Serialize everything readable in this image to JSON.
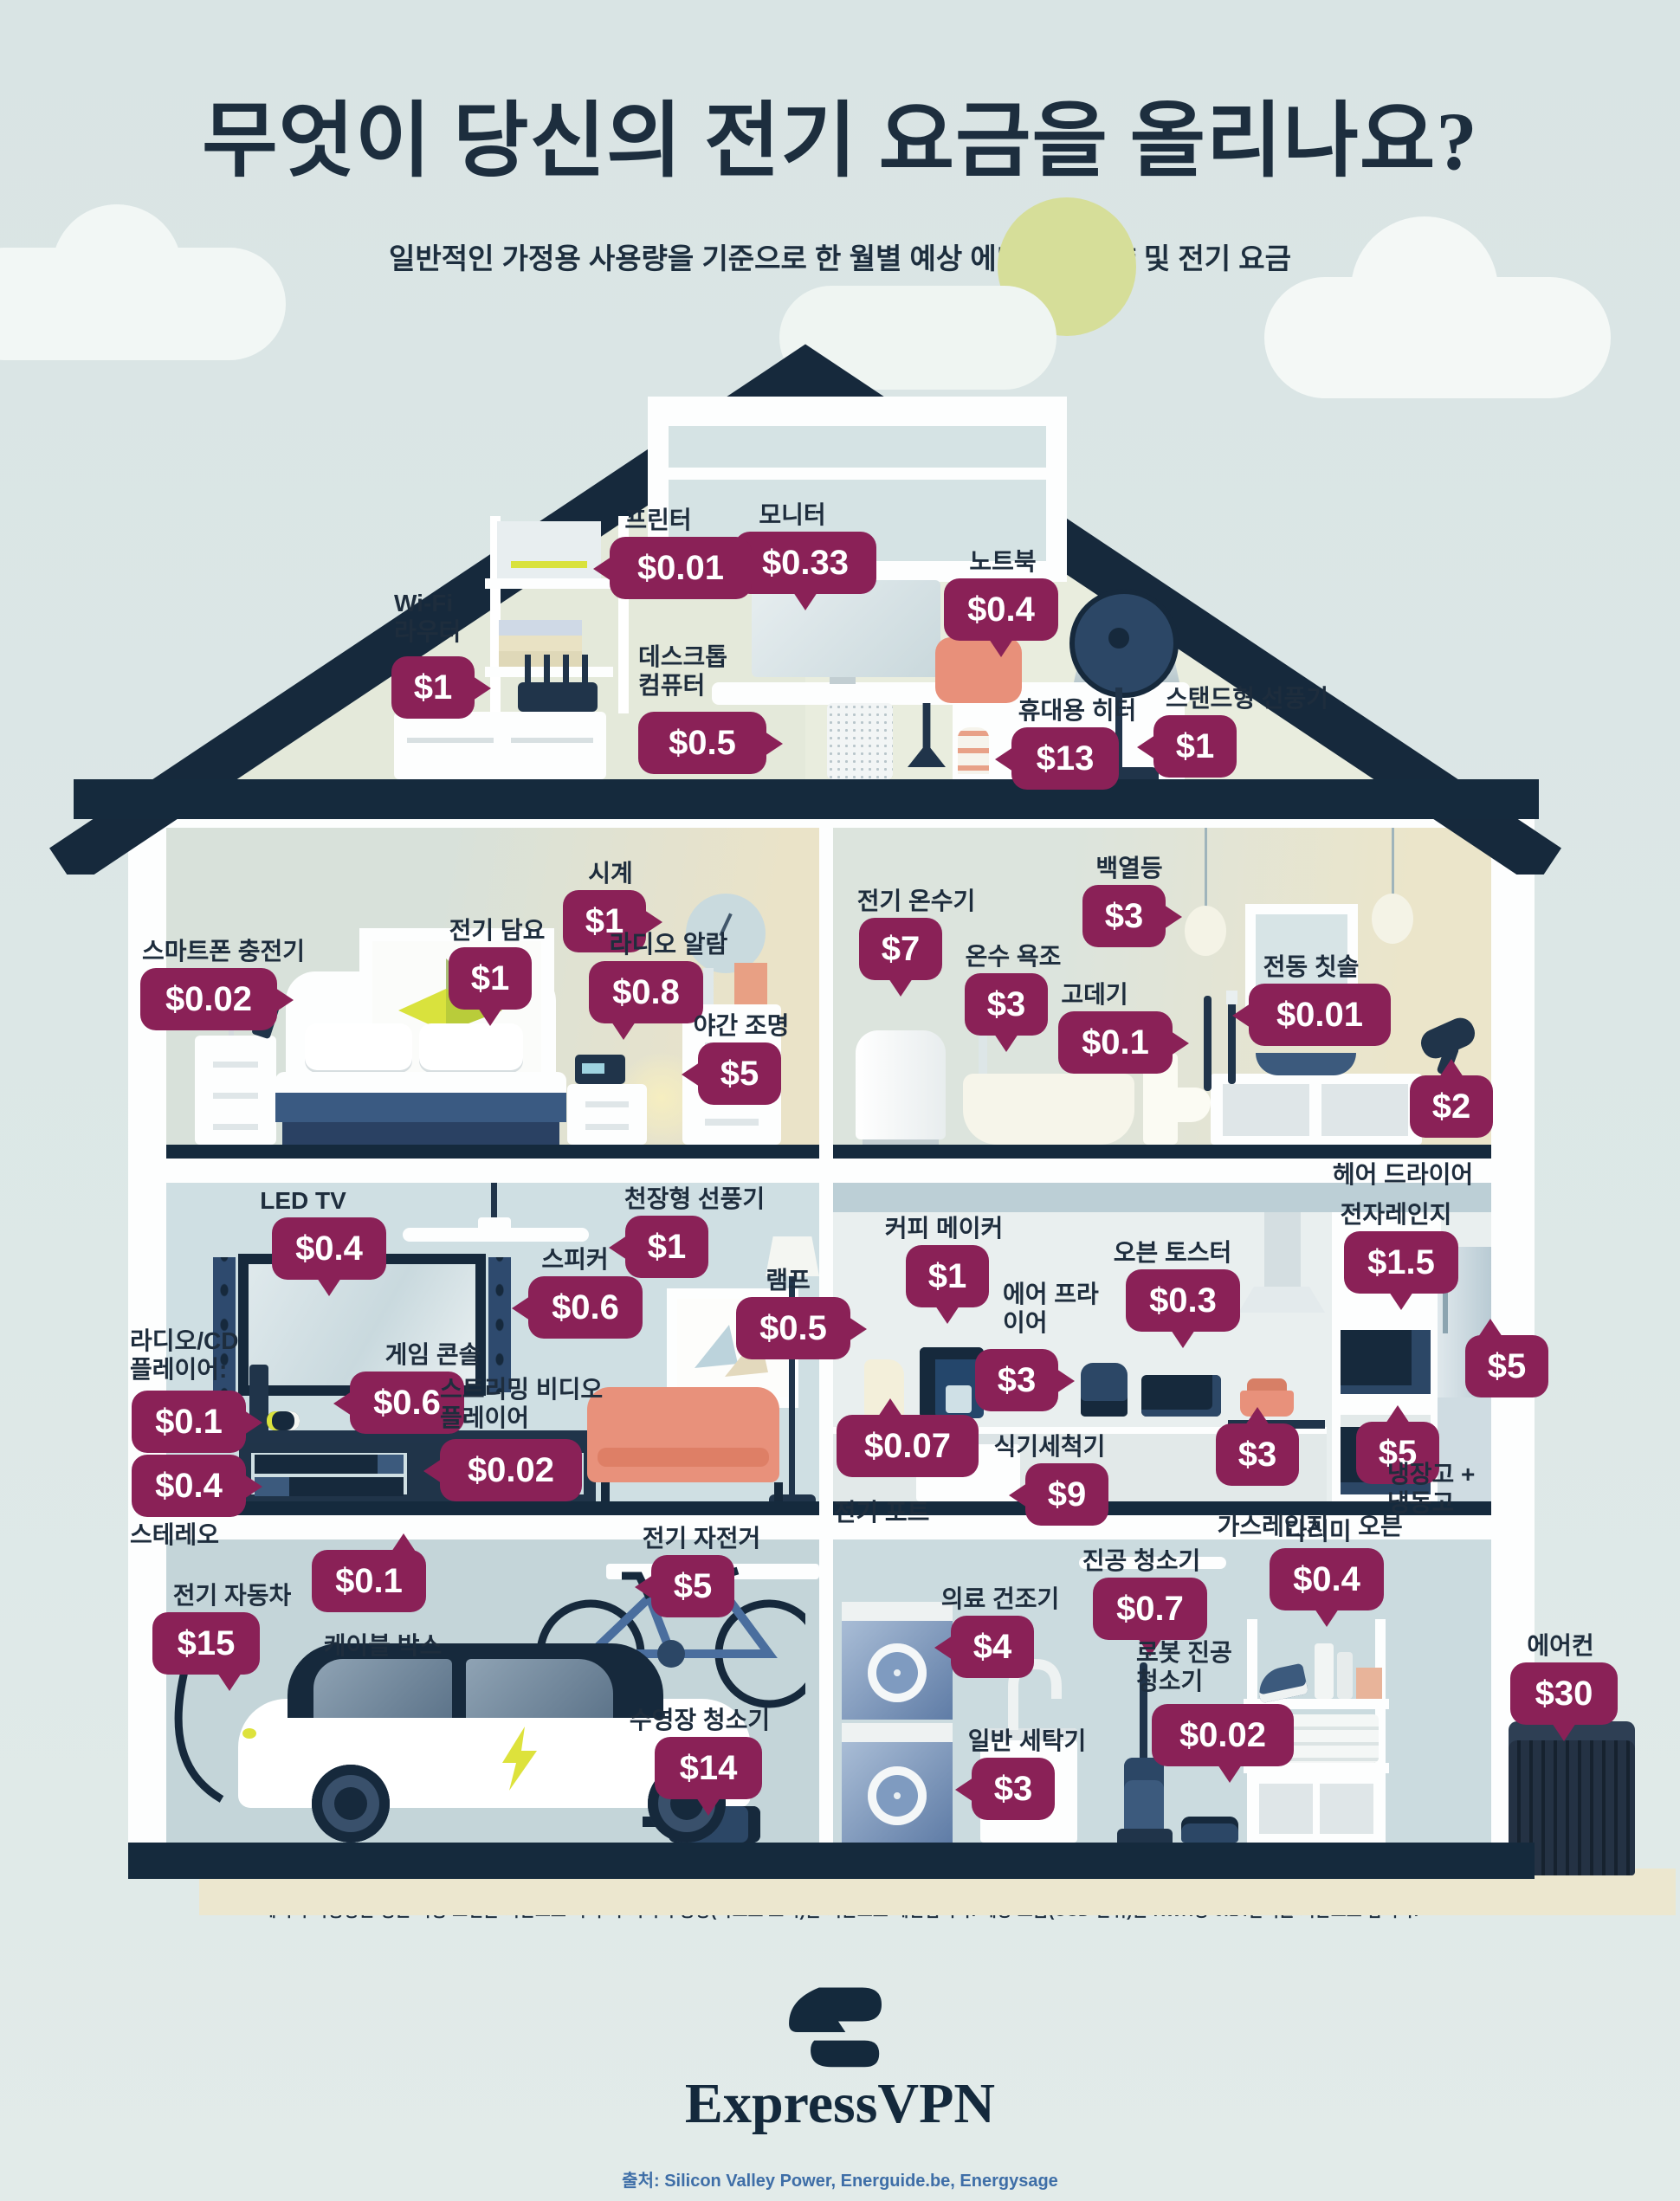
{
  "title": "무엇이 당신의 전기 요금을 올리나요?",
  "subtitle": "일반적인 가정용 사용량을 기준으로 한 월별 예상 에너지 소비량 및 전기 요금",
  "footnote": "에너지 사용량은 평균 작동 조건을 기반으로 하며 각 기기의 용량(와트로 표시)을 기준으로 계산됩니다. 예상 요금(USD 단위)은 KWH당 0.14달러를 기준으로 합니다.",
  "brand": {
    "name": "ExpressVPN"
  },
  "source": "출처: Silicon Valley Power, Energuide.be, Energysage",
  "colors": {
    "bubble": "#8A2157",
    "navy": "#152A3D",
    "sun": "#D6DE99",
    "coral": "#E8907A",
    "lime": "#D9E23D"
  },
  "currency_note": "USD, KWH당 0.14달러",
  "items": [
    {
      "id": "monitor",
      "room": "attic-office",
      "label": "모니터",
      "price": "$0.33"
    },
    {
      "id": "laptop",
      "room": "attic-office",
      "label": "노트북",
      "price": "$0.4"
    },
    {
      "id": "printer",
      "room": "attic-office",
      "label": "프린터",
      "price": "$0.01"
    },
    {
      "id": "wifi-router",
      "room": "attic-office",
      "label": "Wi-Fi\n라우터",
      "price": "$1"
    },
    {
      "id": "desktop-computer",
      "room": "attic-office",
      "label": "데스크톱\n컴퓨터",
      "price": "$0.5"
    },
    {
      "id": "portable-heater",
      "room": "attic-office",
      "label": "휴대용 히터",
      "price": "$13"
    },
    {
      "id": "standing-fan",
      "room": "attic-office",
      "label": "스탠드형 선풍기",
      "price": "$1"
    },
    {
      "id": "wall-clock",
      "room": "bedroom",
      "label": "시계",
      "price": "$1"
    },
    {
      "id": "electric-blanket",
      "room": "bedroom",
      "label": "전기 담요",
      "price": "$1"
    },
    {
      "id": "radio-alarm",
      "room": "bedroom",
      "label": "라디오 알람",
      "price": "$0.8"
    },
    {
      "id": "smartphone-charger",
      "room": "bedroom",
      "label": "스마트폰 충전기",
      "price": "$0.02"
    },
    {
      "id": "night-light",
      "room": "bedroom",
      "label": "야간 조명",
      "price": "$5"
    },
    {
      "id": "electric-water-heater",
      "room": "bathroom",
      "label": "전기 온수기",
      "price": "$7"
    },
    {
      "id": "hot-tub",
      "room": "bathroom",
      "label": "온수 욕조",
      "price": "$3"
    },
    {
      "id": "incandescent-bulb",
      "room": "bathroom",
      "label": "백열등",
      "price": "$3"
    },
    {
      "id": "curling-iron",
      "room": "bathroom",
      "label": "고데기",
      "price": "$0.1"
    },
    {
      "id": "electric-toothbrush",
      "room": "bathroom",
      "label": "전동 칫솔",
      "price": "$0.01"
    },
    {
      "id": "hair-dryer",
      "room": "bathroom",
      "label": "헤어 드라이어",
      "price": "$2"
    },
    {
      "id": "led-tv",
      "room": "living-room",
      "label": "LED TV",
      "price": "$0.4"
    },
    {
      "id": "ceiling-fan",
      "room": "living-room",
      "label": "천장형 선풍기",
      "price": "$1"
    },
    {
      "id": "speakers",
      "room": "living-room",
      "label": "스피커",
      "price": "$0.6"
    },
    {
      "id": "game-console",
      "room": "living-room",
      "label": "게임 콘솔",
      "price": "$0.6"
    },
    {
      "id": "radio-cd-player",
      "room": "living-room",
      "label": "라디오/CD\n플레이어:",
      "price": "$0.1"
    },
    {
      "id": "stereo",
      "room": "living-room",
      "label": "스테레오",
      "price": "$0.4"
    },
    {
      "id": "streaming-player",
      "room": "living-room",
      "label": "스트리밍 비디오\n플레이어",
      "price": "$0.02"
    },
    {
      "id": "lamp",
      "room": "living-room",
      "label": "램프",
      "price": "$0.5"
    },
    {
      "id": "cable-box",
      "room": "living-room",
      "label": "케이블 박스",
      "price": "$0.1"
    },
    {
      "id": "coffee-maker",
      "room": "kitchen",
      "label": "커피 메이커",
      "price": "$1"
    },
    {
      "id": "air-fryer",
      "room": "kitchen",
      "label": "에어 프라\n이어",
      "price": "$3"
    },
    {
      "id": "toaster-oven",
      "room": "kitchen",
      "label": "오븐 토스터",
      "price": "$0.3"
    },
    {
      "id": "microwave",
      "room": "kitchen",
      "label": "전자레인지",
      "price": "$1.5"
    },
    {
      "id": "electric-kettle",
      "room": "kitchen",
      "label": "전기 포트",
      "price": "$0.07"
    },
    {
      "id": "dishwasher",
      "room": "kitchen",
      "label": "식기세척기",
      "price": "$9"
    },
    {
      "id": "gas-range",
      "room": "kitchen",
      "label": "가스레인지",
      "price": "$3"
    },
    {
      "id": "oven",
      "room": "kitchen",
      "label": "오븐",
      "price": "$5"
    },
    {
      "id": "fridge-freezer",
      "room": "kitchen",
      "label": "냉장고 +\n냉동고",
      "price": "$5"
    },
    {
      "id": "electric-car",
      "room": "garage",
      "label": "전기 자동차",
      "price": "$15"
    },
    {
      "id": "electric-bike",
      "room": "garage",
      "label": "전기 자전거",
      "price": "$5"
    },
    {
      "id": "pool-cleaner",
      "room": "garage",
      "label": "수영장 청소기",
      "price": "$14"
    },
    {
      "id": "clothes-dryer",
      "room": "laundry-room",
      "label": "의료 건조기",
      "price": "$4"
    },
    {
      "id": "vacuum-cleaner",
      "room": "laundry-room",
      "label": "진공 청소기",
      "price": "$0.7"
    },
    {
      "id": "iron",
      "room": "laundry-room",
      "label": "다리미",
      "price": "$0.4"
    },
    {
      "id": "robot-vacuum",
      "room": "laundry-room",
      "label": "로봇 진공\n청소기",
      "price": "$0.02"
    },
    {
      "id": "washing-machine",
      "room": "laundry-room",
      "label": "일반 세탁기",
      "price": "$3"
    },
    {
      "id": "air-conditioner",
      "room": "exterior",
      "label": "에어컨",
      "price": "$30"
    }
  ]
}
